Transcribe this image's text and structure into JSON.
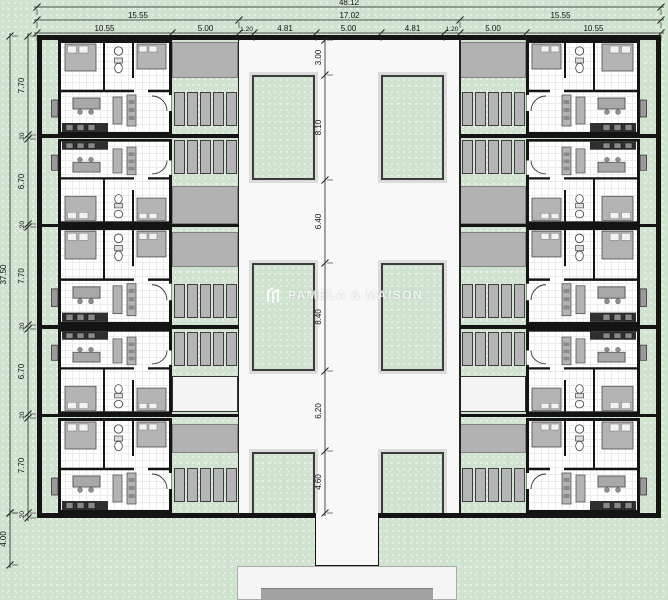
{
  "watermark": {
    "brand": "PAMELA & MAISON"
  },
  "dimensions": {
    "top": {
      "total": "48.12",
      "row2": [
        "15.55",
        "17.02",
        "15.55"
      ],
      "row3": [
        "10.55",
        "5.00",
        "1.20",
        "4.81",
        "5.00",
        "4.81",
        "1.20",
        "5.00",
        "10.55"
      ]
    },
    "left": {
      "total": "37.50",
      "front_setback": "4.00",
      "segments": [
        "7.70",
        ".20",
        "6.70",
        ".20",
        "7.70",
        ".20",
        "6.70",
        ".20",
        "7.70",
        ".20"
      ]
    },
    "center": {
      "segments": [
        "3.00",
        "8.10",
        "6.40",
        "8.40",
        "6.20",
        "4.60"
      ]
    }
  },
  "colors": {
    "landscape_green": "#cfe3cf",
    "pavement_gray": "#b2b2b2",
    "road_white": "#f8f8f8",
    "wall_black": "#141414",
    "stall_gray": "#b5b5b5"
  }
}
